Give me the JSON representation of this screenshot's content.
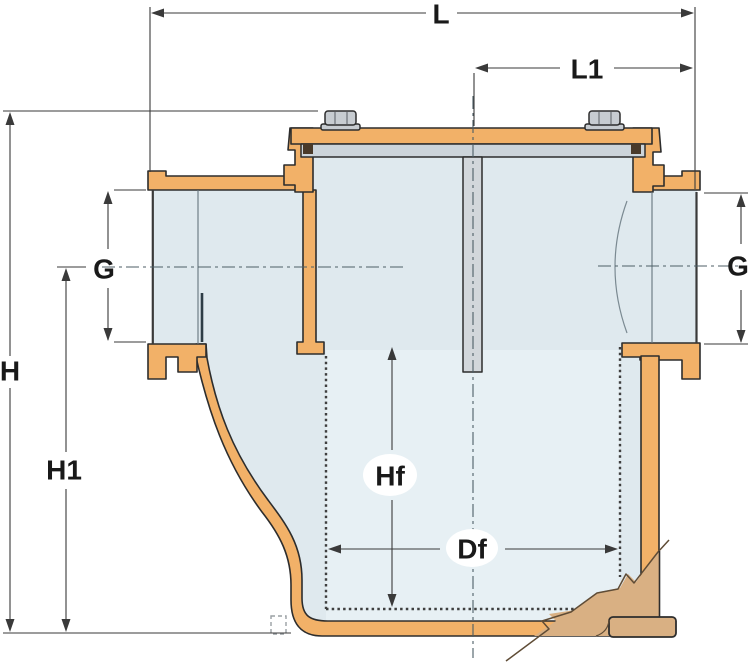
{
  "diagram": {
    "description": "Cross-section engineering drawing of a raw water strainer (cooling water filter) with dimension callouts",
    "labels": {
      "L": "L",
      "L1": "L1",
      "G_left": "G",
      "G_right": "G",
      "H": "H",
      "H1": "H1",
      "Hf": "Hf",
      "Df": "Df"
    },
    "colors": {
      "wall": "#f2b168",
      "drain": "#d9b083",
      "interior": "#dfe9ee",
      "basket": "#e7f0f4",
      "lidgray": "#ccd4da",
      "metal": "#c7ccd1",
      "outline": "#2d2d2d",
      "dimline": "#3a3a3a",
      "label": "#191919",
      "background": "#ffffff"
    }
  }
}
